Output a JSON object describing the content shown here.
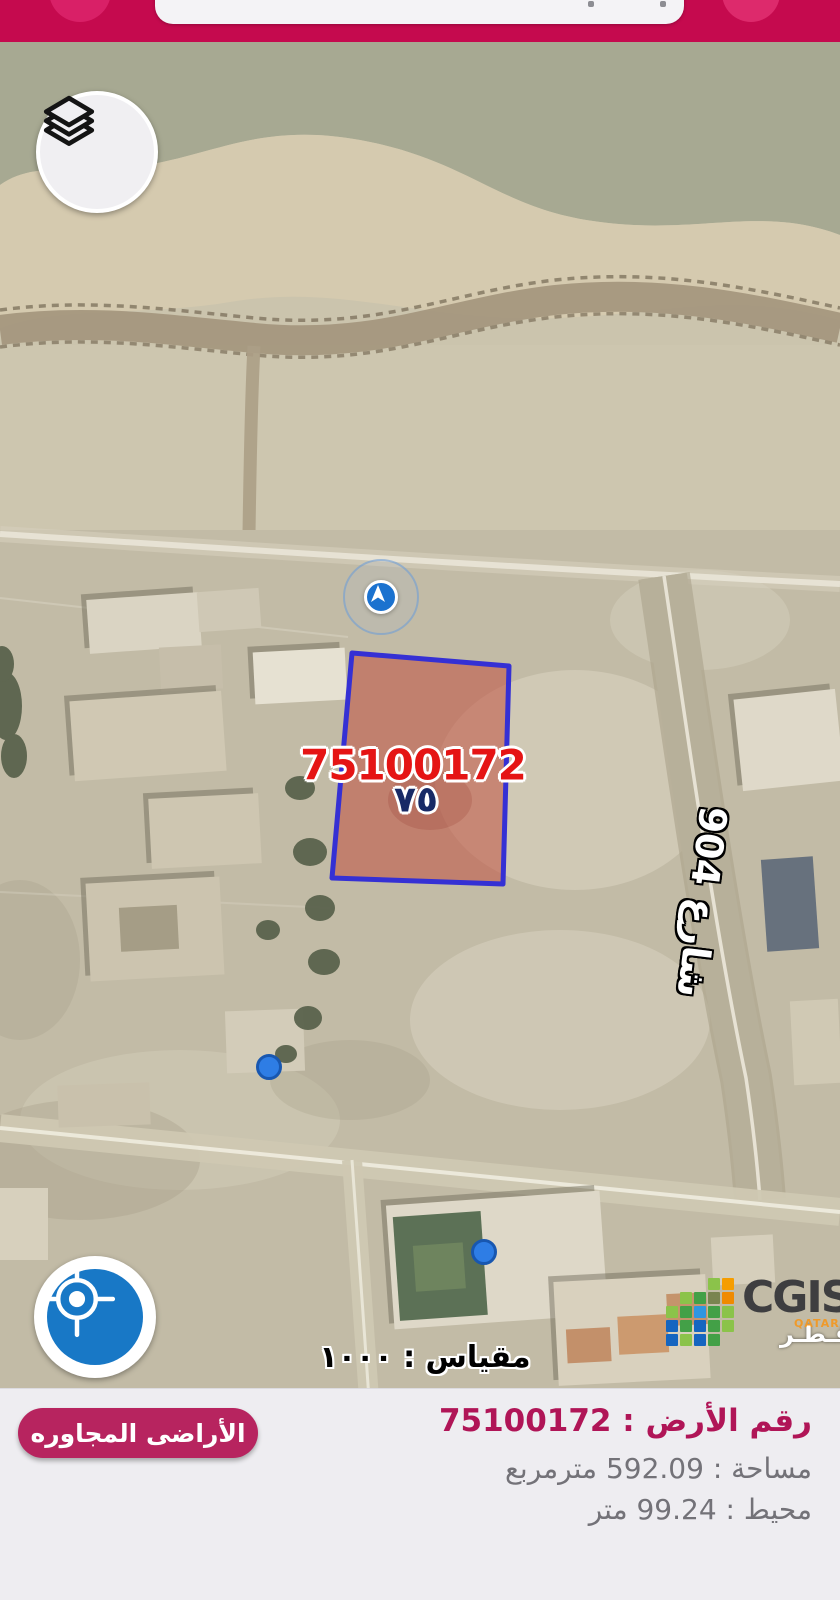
{
  "header": {
    "search_value": ""
  },
  "map": {
    "parcel_label": "75100172",
    "parcel_label_arabic": "٧٥",
    "street_label": "شارع 904",
    "scale_text": "مقياس : ١٠٠٠"
  },
  "logo": {
    "title": "CGIS",
    "country_en": "QATAR",
    "country_ar": "قـطـر"
  },
  "panel": {
    "neighbors_button_label": "الأراضى المجاوره",
    "parcel_line": "رقم الأرض : 75100172",
    "area_line": "مساحة : 592.09 مترمربع",
    "perimeter_line": "محيط : 99.24 متر",
    "fields": {
      "parcel_number": "75100172",
      "area_sqm": "592.09",
      "perimeter_m": "99.24",
      "scale": "١٠٠٠"
    }
  },
  "icons": {
    "layers": "layers-icon",
    "compass": "navigation-arrow-icon",
    "target": "crosshair-icon"
  },
  "colors": {
    "topbar": "#c50a4e",
    "topbarCircle": "#d92067",
    "panelBg": "#eeedf1",
    "buttonPink": "#b7245f",
    "infoMagenta": "#b01557",
    "infoGray": "#737278",
    "parcelFill": "#bf4a3c",
    "parcelStroke": "#3530d4",
    "parcelText": "#e51414",
    "parcelNavy": "#182a66",
    "dotBlue": "#2e7de5",
    "dotBorder": "#1857b0",
    "targetBlue": "#1878c6",
    "compassBlue": "#1b72cf"
  }
}
